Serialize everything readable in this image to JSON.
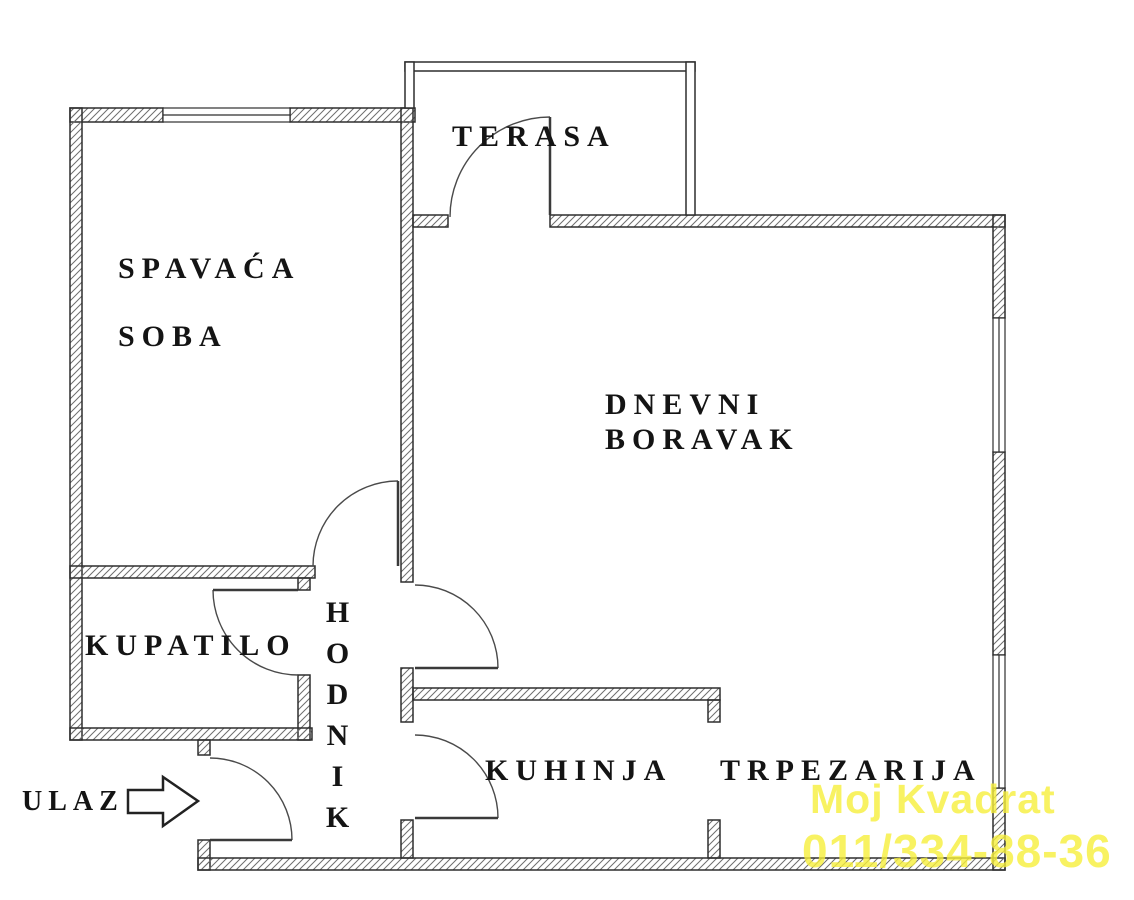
{
  "plan": {
    "terasa": "TERASA",
    "spavaca_line1": "SPAVAĆA",
    "spavaca_line2": "SOBA",
    "dnevni_line1": "DNEVNI",
    "dnevni_line2": "BORAVAK",
    "kupatilo": "KUPATILO",
    "hodnik": "HODNIK",
    "kuhinja": "KUHINJA",
    "trpezarija": "TRPEZARIJA",
    "ulaz": "ULAZ"
  },
  "watermark": {
    "line1": "Moj Kvadrat",
    "line2": "011/334-88-36",
    "color": "#F7EF3C"
  },
  "colors": {
    "background": "#ffffff",
    "wall_outline": "#2e2e2e",
    "hatch": "#6e6e6e",
    "label_text": "#141414"
  }
}
